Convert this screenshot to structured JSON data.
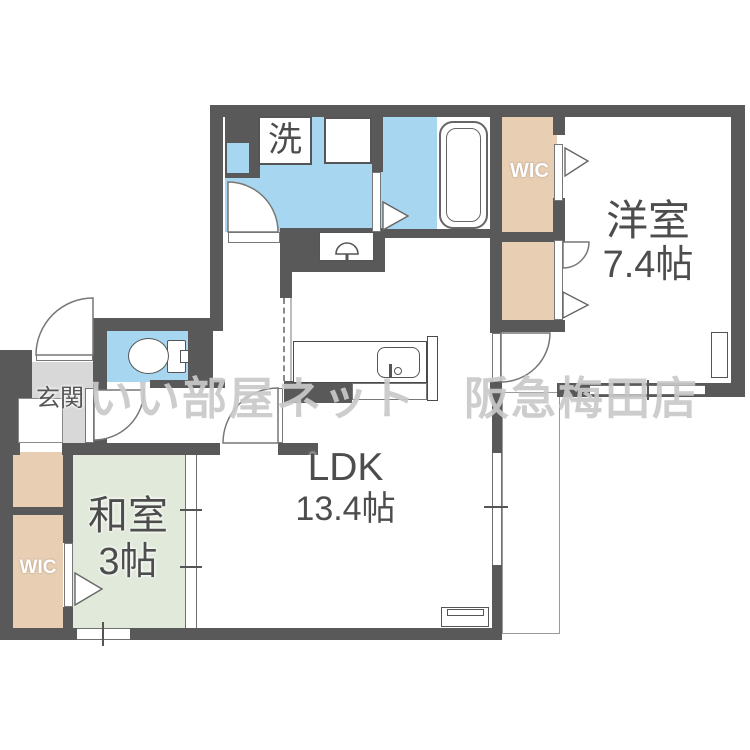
{
  "plan_title": "floor-plan",
  "watermark": "いい部屋ネット　阪急梅田店",
  "rooms": {
    "bedroom": {
      "name": "洋室",
      "size": "7.4帖"
    },
    "ldk": {
      "name": "LDK",
      "size": "13.4帖"
    },
    "washitsu": {
      "name": "和室",
      "size": "3帖"
    },
    "genkan": {
      "label": "玄関"
    },
    "wic_top": {
      "label": "WIC"
    },
    "wic_left": {
      "label": "WIC"
    }
  },
  "fixtures": {
    "laundry": "洗"
  },
  "colors": {
    "wall": "#595959",
    "water_rooms": "#a7d6f0",
    "closet": "#e8cfb4",
    "tatami": "#e0e9da",
    "genkan_floor": "#d8d8d8",
    "watermark_text": "#c9c9c9"
  }
}
